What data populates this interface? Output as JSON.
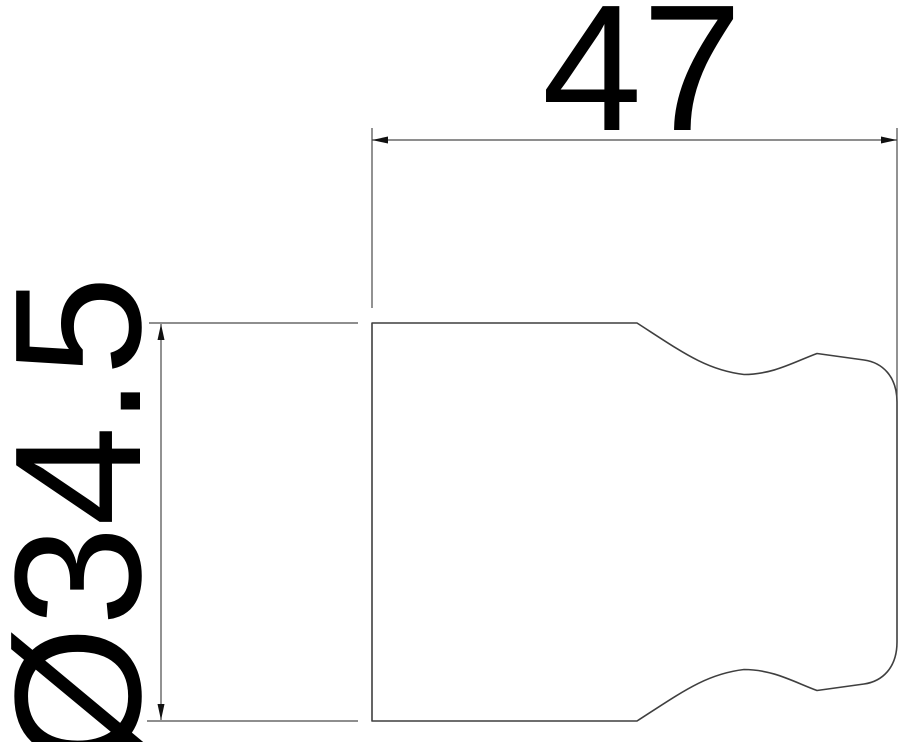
{
  "drawing": {
    "type": "technical-dimension-drawing",
    "colors": {
      "background": "#ffffff",
      "outline": "#3f3f3f",
      "dimension": "#4a4a4a",
      "text": "#000000",
      "arrow": "#111111"
    },
    "dimensions": {
      "width": {
        "label": "47"
      },
      "diameter": {
        "label": "Ø34.5"
      }
    }
  }
}
